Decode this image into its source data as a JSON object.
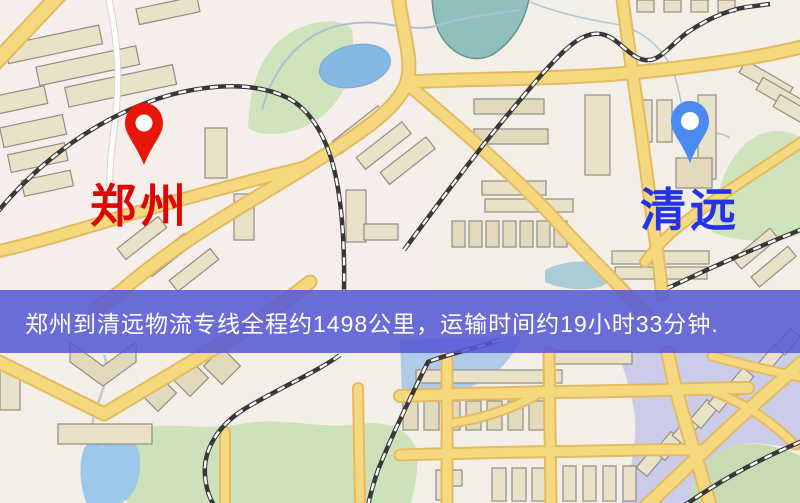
{
  "banner": {
    "text": "郑州到清远物流专线全程约1498公里，运输时间约19小时33分钟.",
    "background_color": "#5558d6",
    "text_color": "#ffffff"
  },
  "markers": {
    "origin": {
      "label": "郑州",
      "label_color": "#dd0604",
      "pin_color": "#e8170b",
      "pin_icon": "red-map-pin"
    },
    "destination": {
      "label": "清远",
      "label_color": "#2433e6",
      "pin_color": "#4b8bf0",
      "pin_icon": "blue-map-pin"
    }
  },
  "map_palette": {
    "background": "#f3eee6",
    "road_fill": "#f6d97e",
    "road_casing": "#e4bb62",
    "building_fill": "#eae1c9",
    "building_stroke": "#908e86",
    "park_green": "#cfe3bc",
    "pond_teal": "#8fc0bc",
    "water_blue": "#9cc8ec",
    "railway": "#383838",
    "district_tint": "#c3c6ea"
  }
}
